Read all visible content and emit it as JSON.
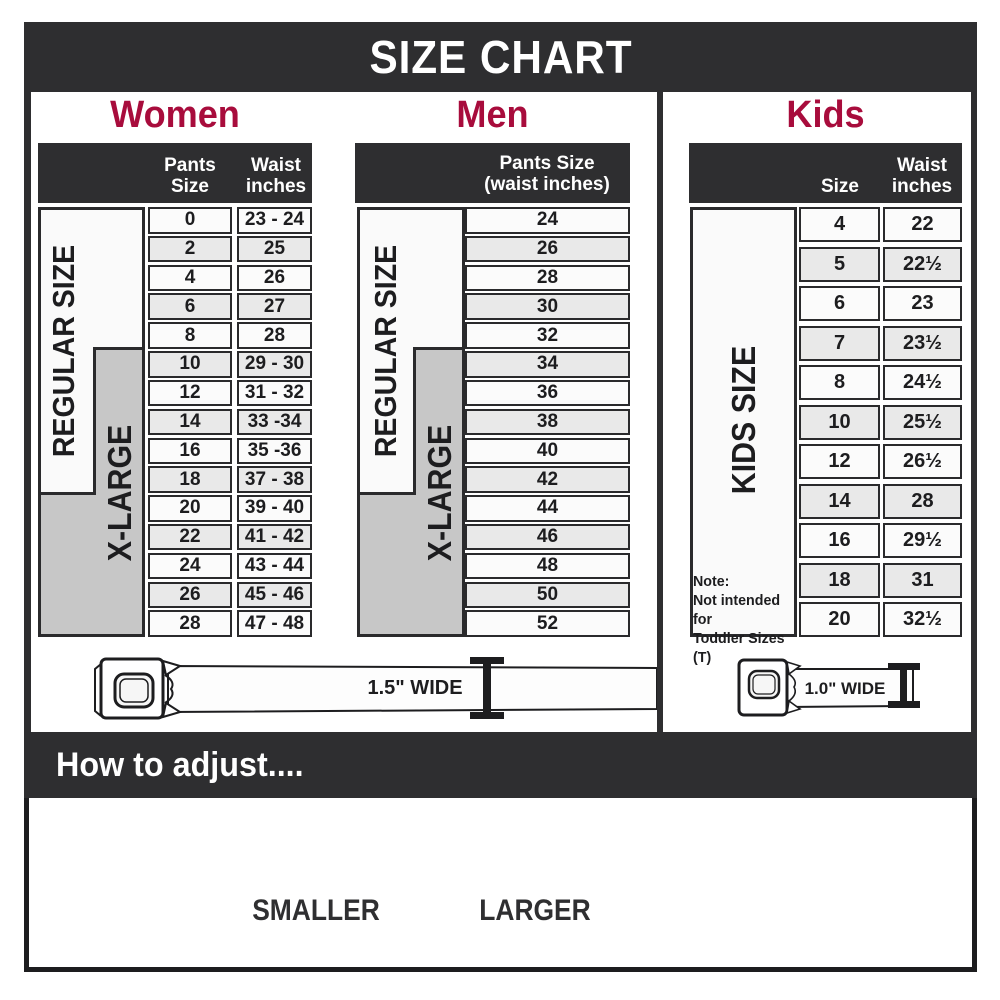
{
  "title": "SIZE CHART",
  "colors": {
    "accent": "#A80C3C",
    "bar": "#2E2E30",
    "row_alt": "#E9E9E9",
    "label_gray": "#C7C7C7"
  },
  "women": {
    "heading": "Women",
    "col_pants": "Pants Size",
    "col_waist_1": "Waist",
    "col_waist_2": "inches",
    "regular": "REGULAR SIZE",
    "xlarge": "X-LARGE",
    "belt_width": "1.5\" WIDE",
    "rows": [
      {
        "size": "0",
        "waist": "23 - 24"
      },
      {
        "size": "2",
        "waist": "25"
      },
      {
        "size": "4",
        "waist": "26"
      },
      {
        "size": "6",
        "waist": "27"
      },
      {
        "size": "8",
        "waist": "28"
      },
      {
        "size": "10",
        "waist": "29 - 30"
      },
      {
        "size": "12",
        "waist": "31 - 32"
      },
      {
        "size": "14",
        "waist": "33 -34"
      },
      {
        "size": "16",
        "waist": "35 -36"
      },
      {
        "size": "18",
        "waist": "37 - 38"
      },
      {
        "size": "20",
        "waist": "39 - 40"
      },
      {
        "size": "22",
        "waist": "41 - 42"
      },
      {
        "size": "24",
        "waist": "43 - 44"
      },
      {
        "size": "26",
        "waist": "45 - 46"
      },
      {
        "size": "28",
        "waist": "47 - 48"
      }
    ]
  },
  "men": {
    "heading": "Men",
    "col_1": "Pants Size",
    "col_2": "(waist inches)",
    "regular": "REGULAR SIZE",
    "xlarge": "X-LARGE",
    "rows": [
      "24",
      "26",
      "28",
      "30",
      "32",
      "34",
      "36",
      "38",
      "40",
      "42",
      "44",
      "46",
      "48",
      "50",
      "52"
    ]
  },
  "kids": {
    "heading": "Kids",
    "col_size": "Size",
    "col_waist_1": "Waist",
    "col_waist_2": "inches",
    "side_label": "KIDS SIZE",
    "note_1": "Note:",
    "note_2": "Not intended for",
    "note_3": "Toddler Sizes (T)",
    "belt_width": "1.0\" WIDE"
  },
  "kids_rows": [
    {
      "size": "4",
      "waist": "22"
    },
    {
      "size": "5",
      "waist": "22½"
    },
    {
      "size": "6",
      "waist": "23"
    },
    {
      "size": "7",
      "waist": "23½"
    },
    {
      "size": "8",
      "waist": "24½"
    },
    {
      "size": "10",
      "waist": "25½"
    },
    {
      "size": "12",
      "waist": "26½"
    },
    {
      "size": "14",
      "waist": "28"
    },
    {
      "size": "16",
      "waist": "29½"
    },
    {
      "size": "18",
      "waist": "31"
    },
    {
      "size": "20",
      "waist": "32½"
    }
  ],
  "adjust": {
    "heading": "How to adjust....",
    "smaller": "SMALLER",
    "larger": "LARGER"
  }
}
